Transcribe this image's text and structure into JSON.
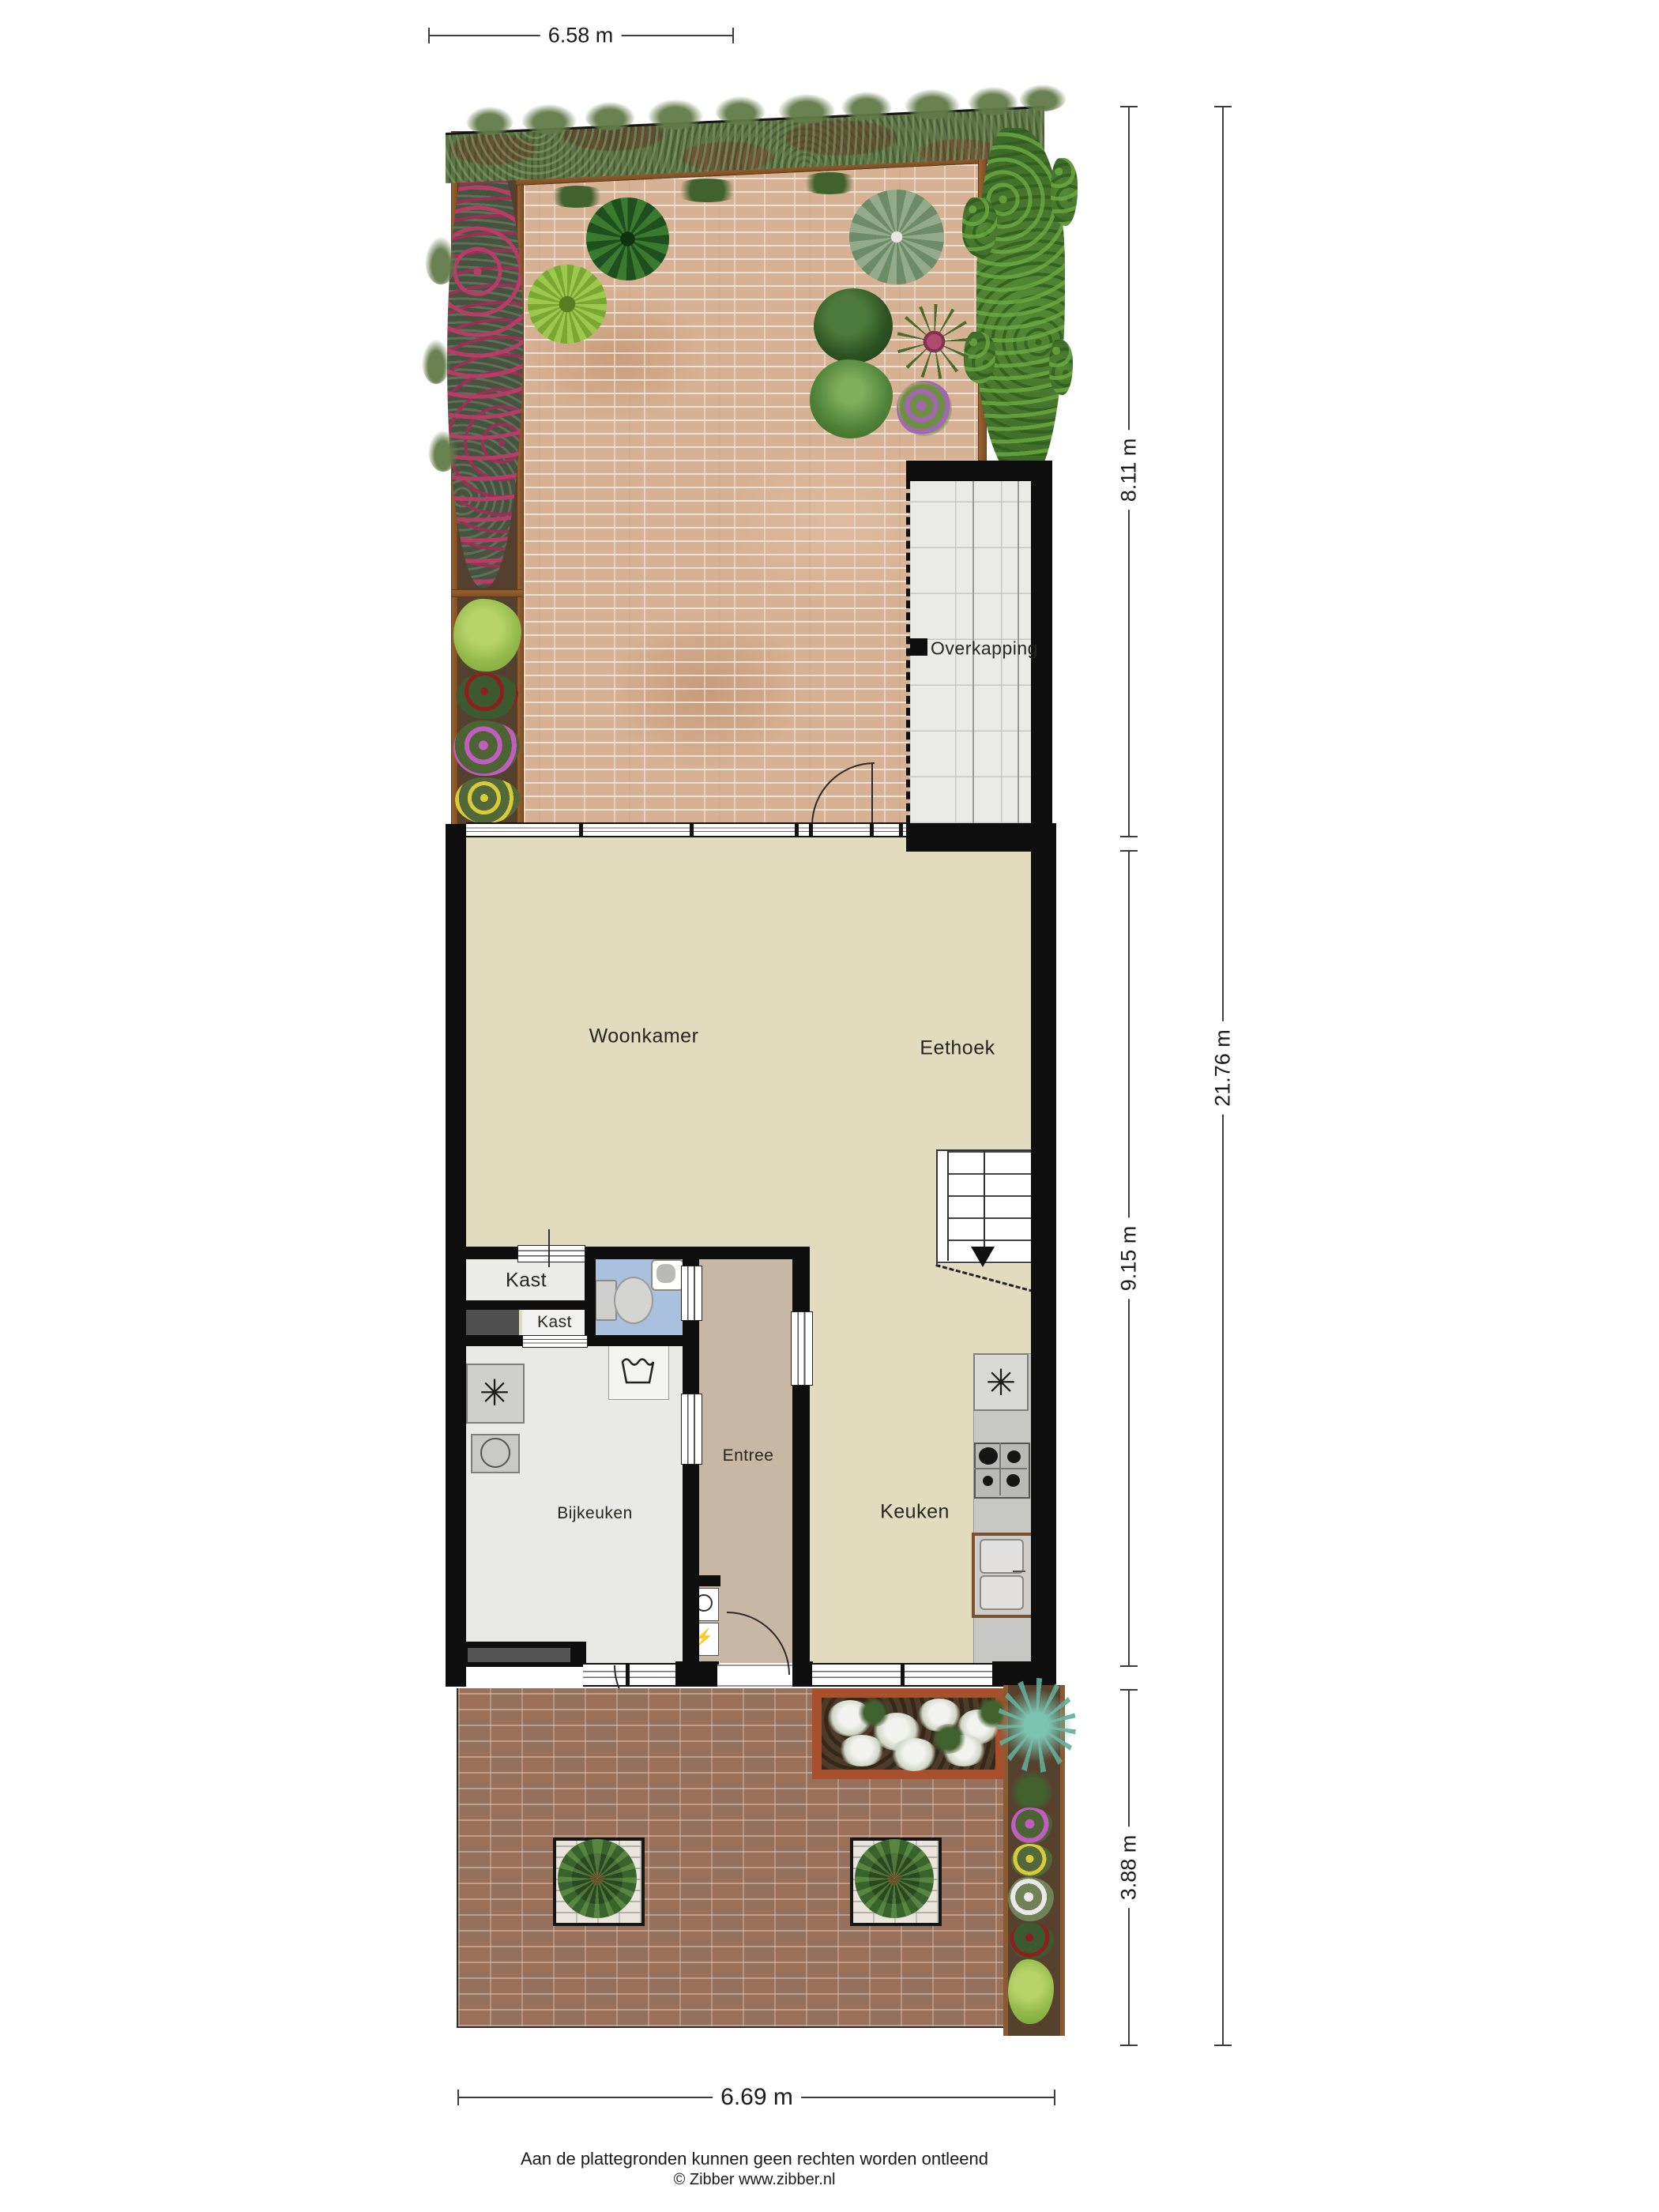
{
  "dimensions": {
    "top_width": "6.58 m",
    "garden_depth": "8.11 m",
    "house_depth": "9.15 m",
    "front_garden_depth": "3.88 m",
    "total_depth": "21.76 m",
    "bottom_width": "6.69 m"
  },
  "rooms": {
    "overkapping": "Overkapping",
    "woonkamer": "Woonkamer",
    "eethoek": "Eethoek",
    "kast_boven": "Kast",
    "kast_onder": "Kast",
    "entree": "Entree",
    "bijkeuken": "Bijkeuken",
    "keuken": "Keuken"
  },
  "icons": {
    "extractor_fan": "✳",
    "ventilation_fan": "✳",
    "electric_meter": "⚡"
  },
  "footer": {
    "disclaimer": "Aan de plattegronden kunnen geen rechten worden ontleend",
    "copyright": "© Zibber www.zibber.nl"
  },
  "colors": {
    "wall": "#0e0e0e",
    "floor_living": "#e2dbbd",
    "floor_bijkeuken": "#e9e9e8",
    "floor_entree": "#c9b7a5",
    "floor_wc": "#a9c1dd",
    "overkapping_floor": "#eaeae8",
    "patio_brick": "#d7b193",
    "front_paving": "#9b6f58",
    "hedge_green": "#5c7345",
    "wood_border": "#8a5a33",
    "flower_bed_border": "#a8502c"
  }
}
